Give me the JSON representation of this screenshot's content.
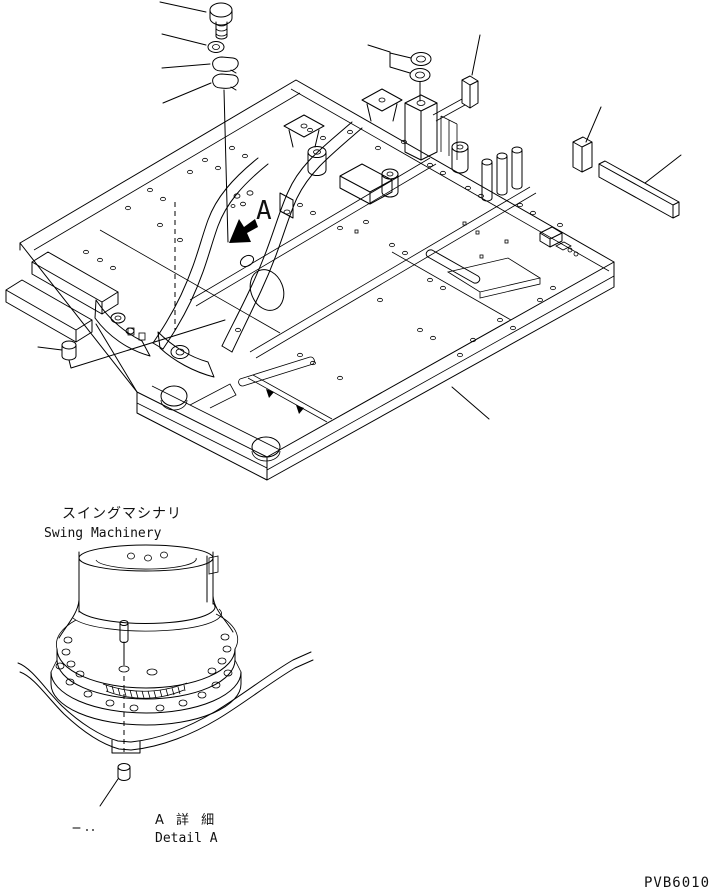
{
  "drawing": {
    "number": "PVB6010",
    "section_label_jp": "スイングマシナリ",
    "section_label_en": "Swing Machinery",
    "detail_marker": "A",
    "detail_caption_jp": "A 詳 細",
    "detail_caption_en": "Detail A"
  },
  "colors": {
    "line": "#000000",
    "background": "#ffffff"
  },
  "parts_callouts": [
    "hex-bolt",
    "washer",
    "cap-plug-upper",
    "cap-plug-lower",
    "seal-washer-upper",
    "seal-washer-lower",
    "shim-block-front",
    "shim-block-rear",
    "flat-bar",
    "grease-plug",
    "main-frame",
    "mount-pin",
    "drain-plug",
    "swing-machinery"
  ]
}
